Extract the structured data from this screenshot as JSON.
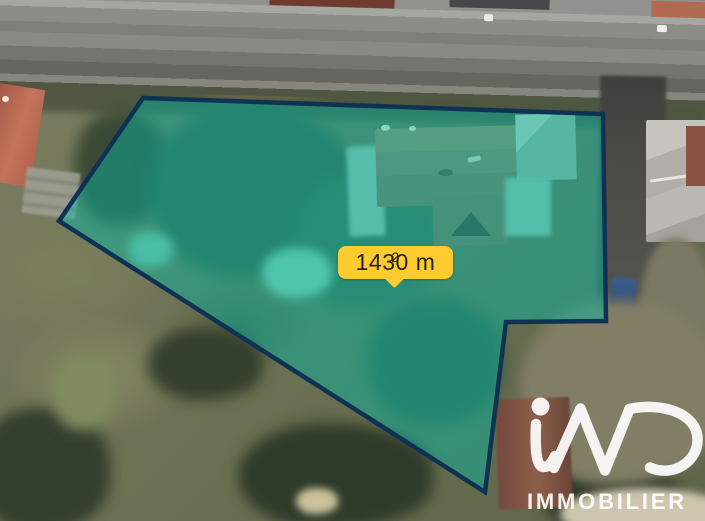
{
  "parcel": {
    "area_label": {
      "text": "1430 m",
      "exponent": "2"
    },
    "vertices": [
      [
        143,
        98
      ],
      [
        603,
        114
      ],
      [
        606,
        321
      ],
      [
        506,
        322
      ],
      [
        485,
        492
      ],
      [
        59,
        221
      ]
    ],
    "fill_color": "rgba(0,186,167,0.45)",
    "border_color": "#0e3253",
    "border_width": 4.5
  },
  "label": {
    "background": "#FFCB2E",
    "text_color": "#26201a"
  },
  "watermark": {
    "brand": "iad",
    "subtext": "IMMOBILIER",
    "color": "#ffffff"
  }
}
